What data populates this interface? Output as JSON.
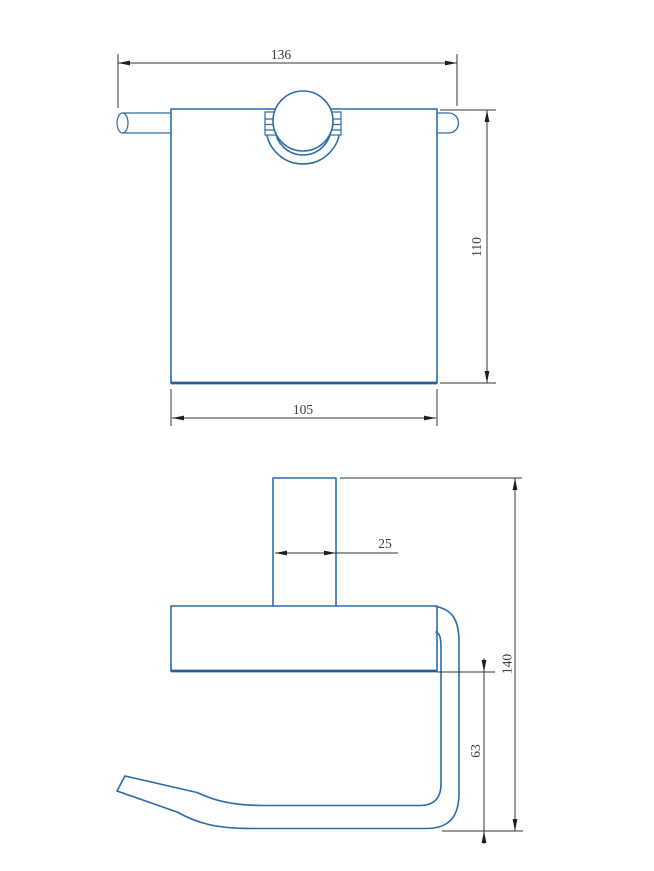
{
  "drawing": {
    "kind": "technical-orthographic-drawing",
    "subject": "wall-mounted paper holder",
    "colors": {
      "part_line": "#2b6ca8",
      "dimension_line": "#333333",
      "dimension_text": "#3c3c3c",
      "background": "#ffffff"
    },
    "front_view": {
      "dim_overall_width": "136",
      "dim_overall_height": "110",
      "dim_plate_width": "105"
    },
    "side_view": {
      "dim_post_width": "25",
      "dim_overall_height": "140",
      "dim_arm_drop": "63"
    }
  }
}
